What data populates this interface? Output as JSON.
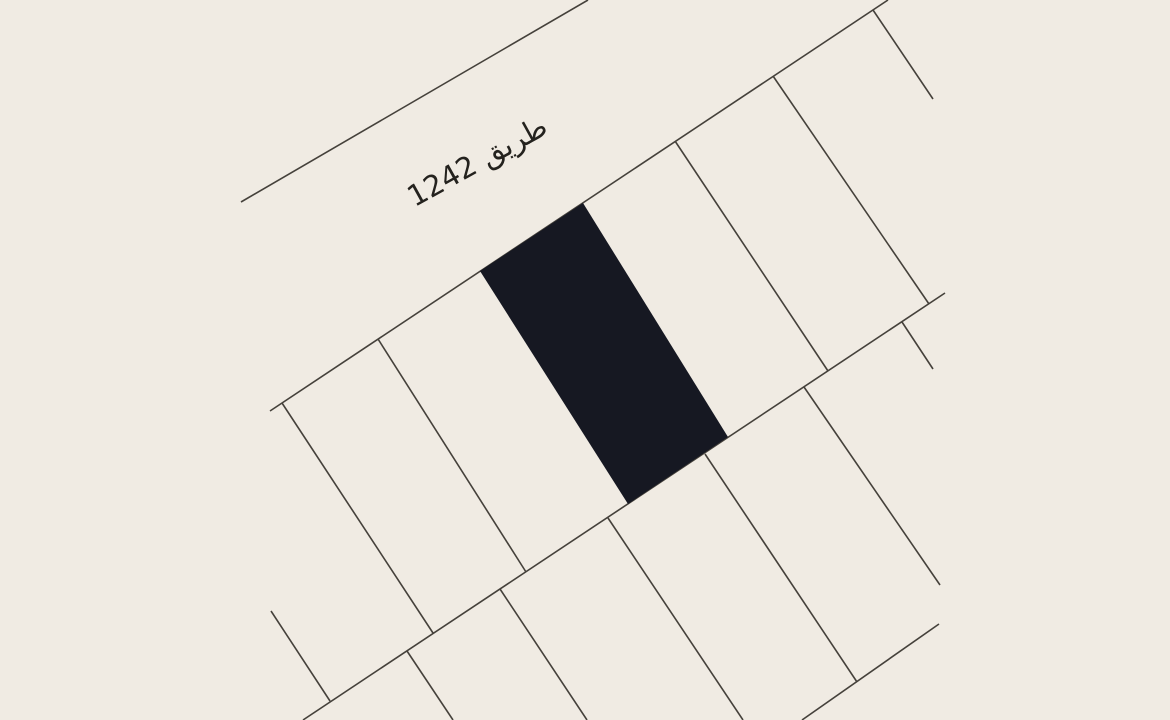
{
  "map": {
    "canvas": {
      "width": 1170,
      "height": 720
    },
    "colors": {
      "background": "#f0ebe3",
      "boundary_line": "#45413b",
      "highlighted_parcel_fill": "#161822",
      "label_text": "#24221e"
    },
    "line_width": 1.6,
    "label": {
      "text": "طريق 1242",
      "x": 482,
      "y": 170,
      "rotation": -29,
      "font_size": 29
    },
    "highlighted_parcel": {
      "name": "selected-plot",
      "points": [
        [
          480,
          271
        ],
        [
          583,
          203
        ],
        [
          728,
          437
        ],
        [
          628,
          504
        ]
      ]
    },
    "lines": [
      {
        "name": "road-1242-north-edge",
        "x1": 241,
        "y1": 202,
        "x2": 588,
        "y2": 0
      },
      {
        "name": "upper-block-top-edge",
        "x1": 270,
        "y1": 411,
        "x2": 888,
        "y2": 0
      },
      {
        "name": "upper-block-divider-1",
        "x1": 282,
        "y1": 403,
        "x2": 433,
        "y2": 633
      },
      {
        "name": "upper-block-divider-2",
        "x1": 378,
        "y1": 339,
        "x2": 526,
        "y2": 572
      },
      {
        "name": "upper-block-divider-3",
        "x1": 675,
        "y1": 141,
        "x2": 828,
        "y2": 371
      },
      {
        "name": "upper-block-divider-4",
        "x1": 773,
        "y1": 76,
        "x2": 929,
        "y2": 304
      },
      {
        "name": "upper-block-end-divider",
        "x1": 873,
        "y1": 10,
        "x2": 933,
        "y2": 99
      },
      {
        "name": "middle-road-edge",
        "x1": 303,
        "y1": 720,
        "x2": 945,
        "y2": 293
      },
      {
        "name": "west-corner-stub",
        "x1": 271,
        "y1": 611,
        "x2": 330,
        "y2": 701
      },
      {
        "name": "lower-block-divider-1",
        "x1": 407,
        "y1": 651,
        "x2": 453,
        "y2": 720
      },
      {
        "name": "lower-block-divider-2",
        "x1": 500,
        "y1": 589,
        "x2": 587,
        "y2": 720
      },
      {
        "name": "lower-block-divider-3",
        "x1": 608,
        "y1": 518,
        "x2": 743,
        "y2": 720
      },
      {
        "name": "lower-block-divider-4",
        "x1": 705,
        "y1": 454,
        "x2": 857,
        "y2": 682
      },
      {
        "name": "lower-block-divider-5",
        "x1": 804,
        "y1": 387,
        "x2": 940,
        "y2": 585
      },
      {
        "name": "lower-block-divider-6",
        "x1": 902,
        "y1": 322,
        "x2": 933,
        "y2": 369
      },
      {
        "name": "lower-block-south-edge",
        "x1": 802,
        "y1": 720,
        "x2": 939,
        "y2": 624
      }
    ]
  }
}
